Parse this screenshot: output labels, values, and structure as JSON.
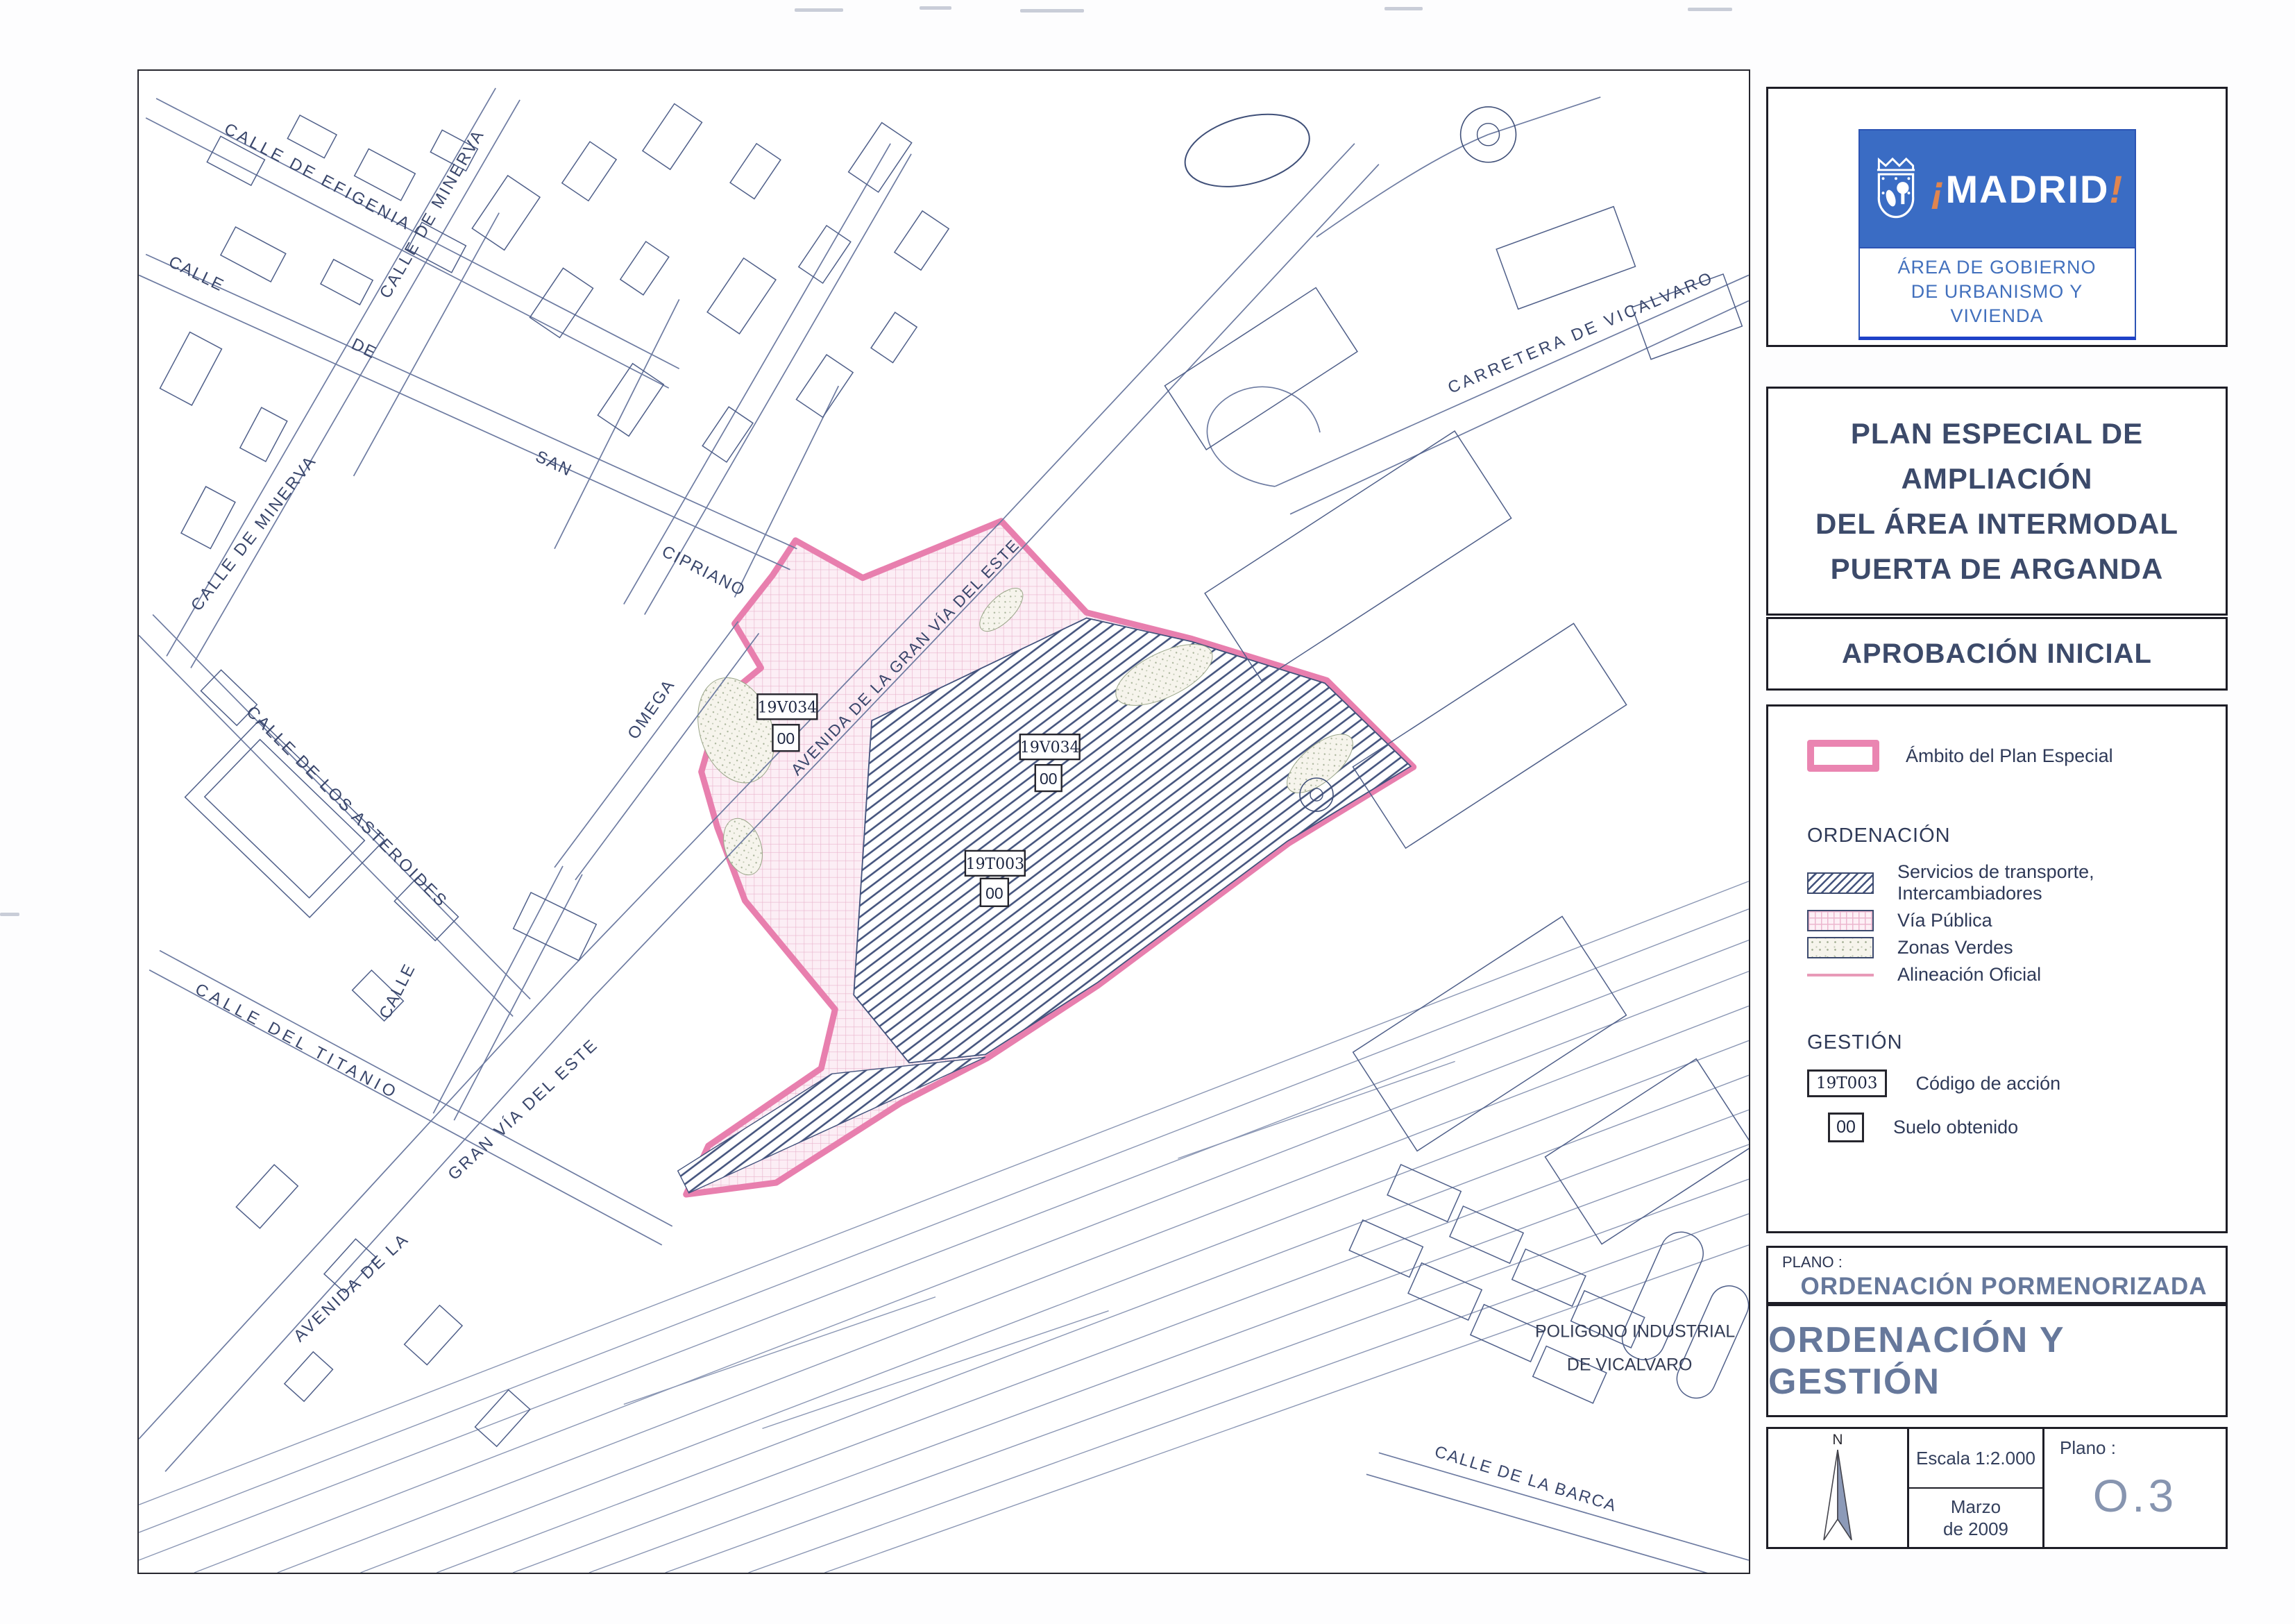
{
  "document": {
    "logo": {
      "brand_prefix": "¡",
      "brand_name": "MADRID",
      "brand_suffix": "!",
      "dept_line1": "ÁREA DE GOBIERNO",
      "dept_line2": "DE URBANISMO Y VIVIENDA"
    },
    "title_lines": [
      "PLAN ESPECIAL DE AMPLIACIÓN",
      "DEL  ÁREA  INTERMODAL",
      "PUERTA  DE  ARGANDA"
    ],
    "phase": "APROBACIÓN INICIAL",
    "legend": {
      "ambito_label": "Ámbito del Plan Especial",
      "ordenacion_heading": "ORDENACIÓN",
      "ordenacion_items": [
        {
          "label": "Servicios de transporte, Intercambiadores"
        },
        {
          "label": "Vía Pública"
        },
        {
          "label": "Zonas Verdes"
        },
        {
          "label": "Alineación Oficial"
        }
      ],
      "gestion_heading": "GESTIÓN",
      "gestion_items": [
        {
          "code": "19T003",
          "label": "Código de acción"
        },
        {
          "code": "00",
          "label": "Suelo obtenido"
        }
      ]
    },
    "plano_block": {
      "label": "PLANO :",
      "subtitle": "ORDENACIÓN PORMENORIZADA",
      "main_title": "ORDENACIÓN Y GESTIÓN"
    },
    "info_block": {
      "north": "N",
      "scale": "Escala 1:2.000",
      "date_line1": "Marzo",
      "date_line2": "de 2009",
      "plano_label": "Plano :",
      "plano_number": "O.3"
    }
  },
  "map": {
    "street_labels": [
      {
        "text": "CALLE DE MINERVA"
      },
      {
        "text": "CALLE DE MINERVA"
      },
      {
        "text": "CALLE  DE  EFIGENIA"
      },
      {
        "text": "CALLE"
      },
      {
        "text": "DE"
      },
      {
        "text": "SAN"
      },
      {
        "text": "CIPRIANO"
      },
      {
        "text": "CALLE  DE  LOS  ASTEROIDES"
      },
      {
        "text": "OMEGA"
      },
      {
        "text": "CALLE"
      },
      {
        "text": "CALLE  DEL  TITANIO"
      },
      {
        "text": "AVENIDA  DE  LA"
      },
      {
        "text": "GRAN  VÍA  DEL  ESTE"
      },
      {
        "text": "AVENIDA  DE  LA  GRAN  VÍA  DEL  ESTE"
      },
      {
        "text": "CARRETERA  DE  VICALVARO"
      },
      {
        "text": "CALLE DE LA BARCA"
      }
    ],
    "place_labels": [
      {
        "text": "POLIGONO  INDUSTRIAL"
      },
      {
        "text": "DE VICALVARO"
      }
    ],
    "area_labels": [
      {
        "code": "19V034",
        "suelo": "00"
      },
      {
        "code": "19V034",
        "suelo": "00"
      },
      {
        "code": "19T003",
        "suelo": "00"
      }
    ]
  },
  "colors": {
    "ambito_pink": "#e87fae",
    "hatch_blue": "#42527c",
    "navy_text": "#3c4a6a",
    "steel_text": "#66789b",
    "logo_blue": "#3a6cc4",
    "logo_orange": "#e0854f"
  }
}
